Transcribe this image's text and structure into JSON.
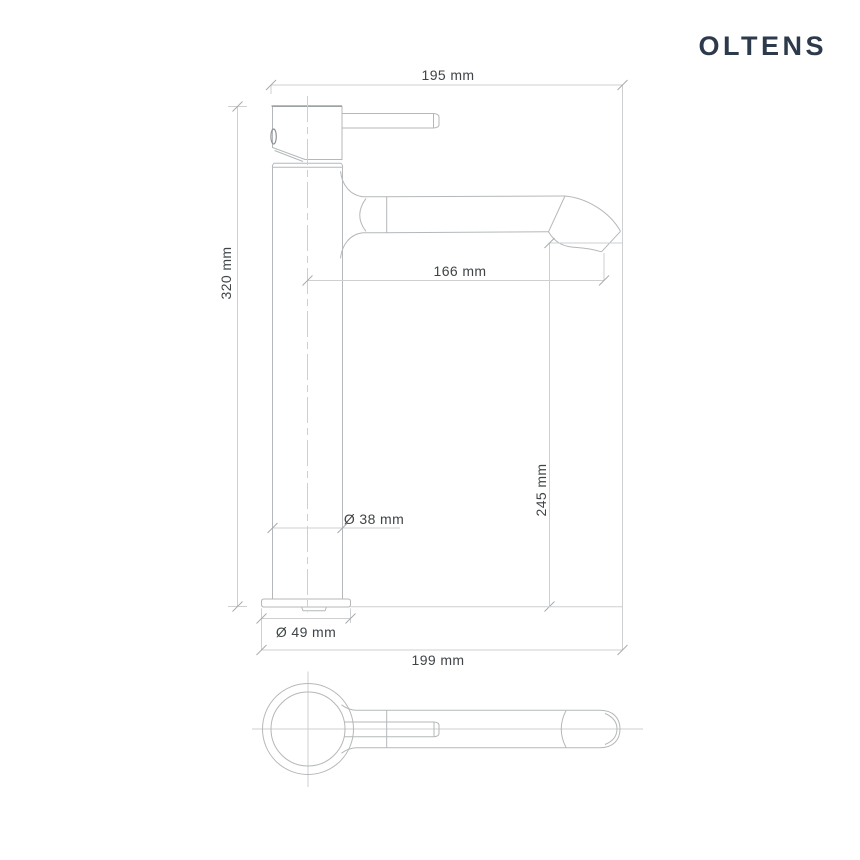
{
  "brand": {
    "logo": "OLTENS"
  },
  "drawing": {
    "type": "technical-dimension-drawing",
    "subject": "tall single-lever basin faucet, side view and top view",
    "dimensions": {
      "top_width": "195 mm",
      "total_height": "320 mm",
      "spout_reach": "166 mm",
      "spout_outlet_height": "245 mm",
      "body_diameter": "Ø 38 mm",
      "base_diameter": "Ø 49 mm",
      "overall_length": "199 mm"
    },
    "colors": {
      "outline_line": "#b4b8ba",
      "dimension_line": "#cdcfd1",
      "label_text": "#3f4447",
      "logo_text": "#2d3a4b",
      "background": "#ffffff"
    }
  }
}
